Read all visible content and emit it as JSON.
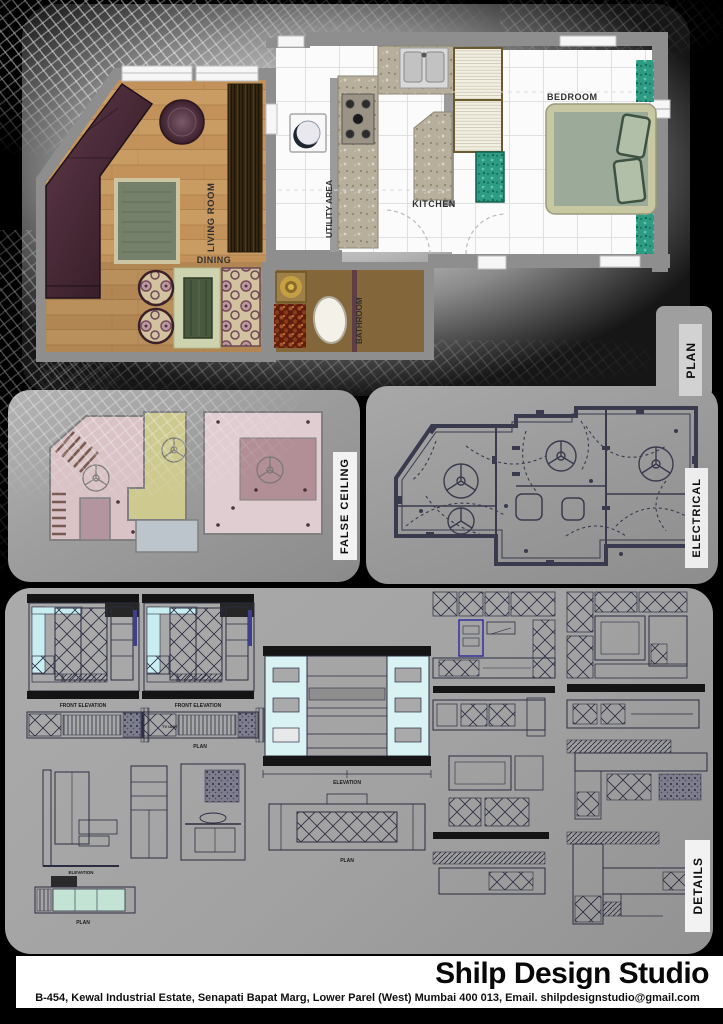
{
  "plan": {
    "tab": "PLAN",
    "rooms": {
      "living": "LIVING ROOM",
      "dining": "DINING",
      "kitchen": "KITCHEN",
      "bedroom": "BEDROOM",
      "bathroom": "BATHROOM",
      "utility": "UTILITY AREA"
    }
  },
  "false_ceiling": {
    "tab": "FALSE CEILING"
  },
  "electrical": {
    "tab": "ELECTRICAL"
  },
  "details": {
    "tab": "DETAILS",
    "captions": {
      "front_elevation": "FRONT ELEVATION",
      "plan": "PLAN",
      "elevation": "ELEVATION",
      "tv_unit": "TV UNIT"
    }
  },
  "footer": {
    "studio_name": "Shilp Design Studio",
    "address": "B-454, Kewal Industrial Estate, Senapati Bapat Marg, Lower Parel (West) Mumbai 400 013, Email. shilpdesignstudio@gmail.com"
  },
  "palette": {
    "teal_accent": "#2e9c84",
    "wood_floor": "#c89a62",
    "sofa_maroon": "#4e2a33",
    "cad_navy": "#2c2c42",
    "cyan_highlight": "#c9eef2",
    "panel_gray": "#9d9d9d"
  }
}
